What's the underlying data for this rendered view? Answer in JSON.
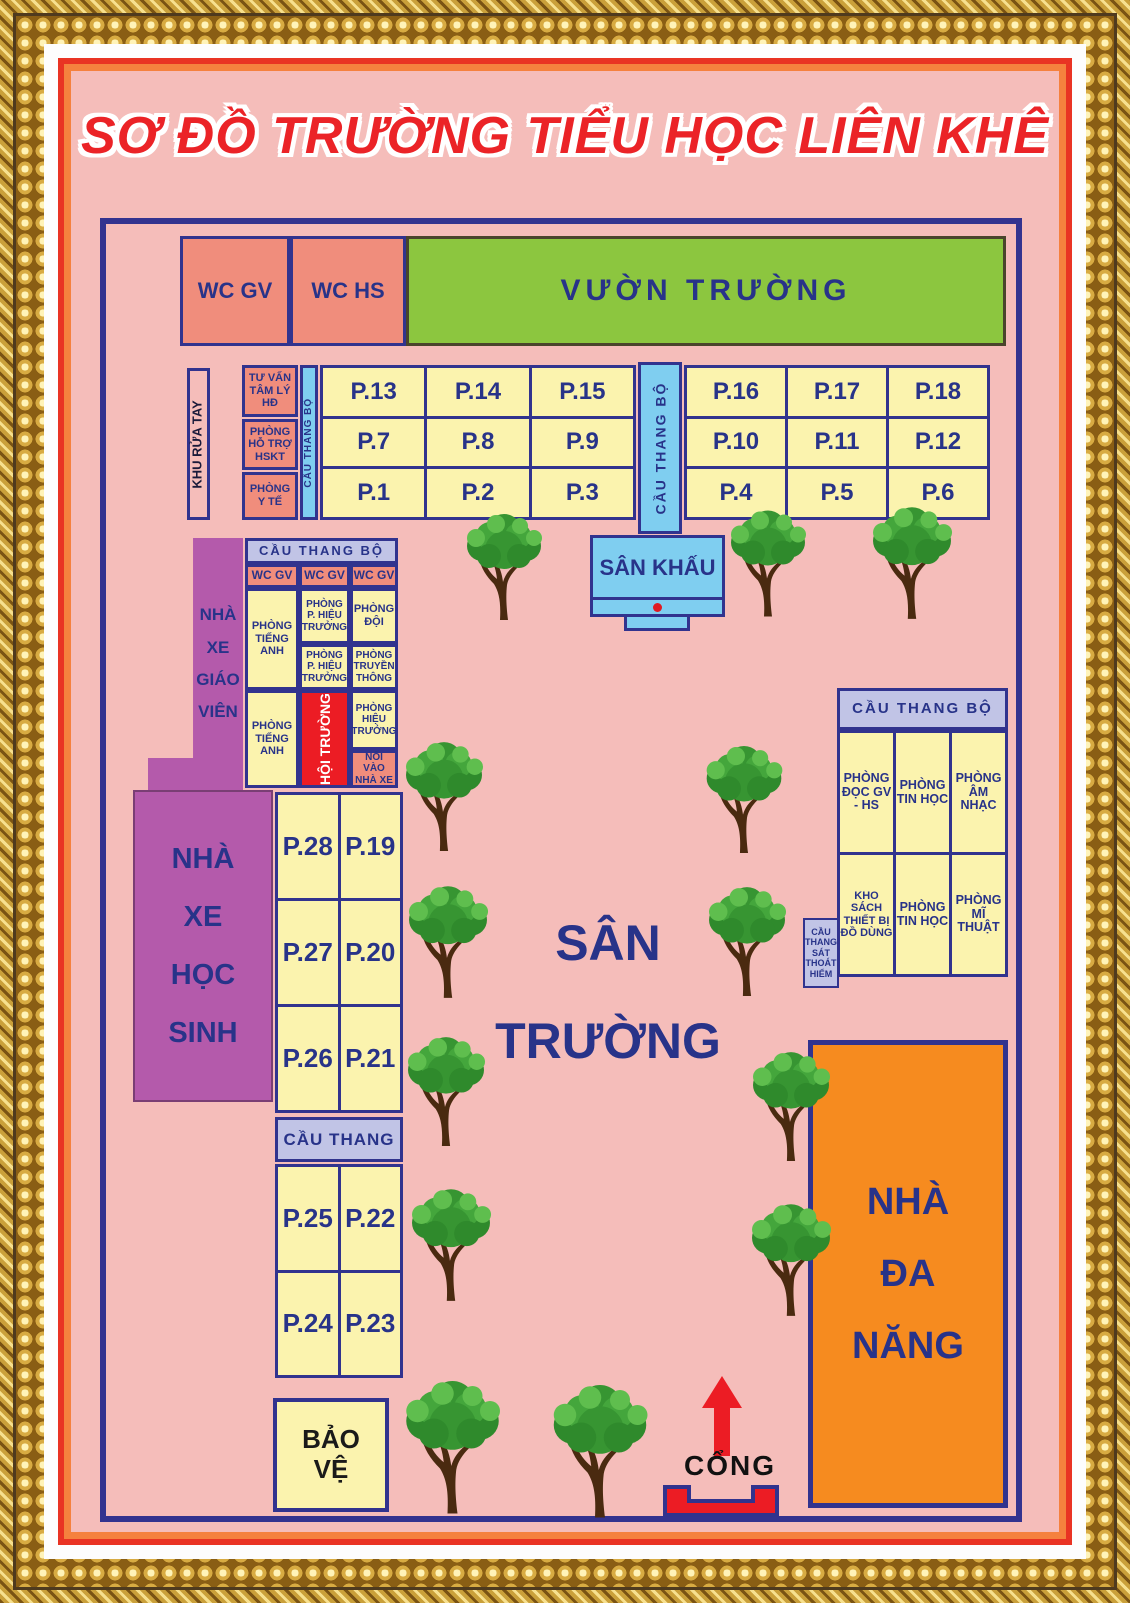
{
  "title": "SƠ ĐỒ TRƯỜNG TIỂU HỌC LIÊN KHÊ",
  "north": {
    "wc_gv": "WC GV",
    "wc_hs": "WC HS",
    "garden": "VƯỜN TRƯỜNG",
    "wash": "KHU RỬA TAY",
    "counsel": "TƯ VẤN TÂM LÝ HĐ",
    "support": "PHÒNG HỖ TRỢ HSKT",
    "medical": "PHÒNG Y TẾ",
    "stair_west": "CẦU THANG BỘ",
    "stair_mid": "CẦU THANG BỘ",
    "rooms_west": [
      [
        "P.13",
        "P.14",
        "P.15"
      ],
      [
        "P.7",
        "P.8",
        "P.9"
      ],
      [
        "P.1",
        "P.2",
        "P.3"
      ]
    ],
    "rooms_east": [
      [
        "P.16",
        "P.17",
        "P.18"
      ],
      [
        "P.10",
        "P.11",
        "P.12"
      ],
      [
        "P.4",
        "P.5",
        "P.6"
      ]
    ]
  },
  "stage": {
    "label": "SÂN KHẤU"
  },
  "admin": {
    "stair": "CẦU THANG BỘ",
    "wc": [
      "WC GV",
      "WC GV",
      "WC GV"
    ],
    "english1": "PHÒNG TIẾNG ANH",
    "vice1": "PHÒNG P. HIỆU TRƯỞNG",
    "team": "PHÒNG ĐỘI",
    "vice2": "PHÒNG P. HIỆU TRƯỞNG",
    "media": "PHÒNG TRUYỀN THÔNG",
    "english2": "PHÒNG TIẾNG ANH",
    "hall": "HỘI TRƯỜNG",
    "principal": "PHÒNG HIỆU TRƯỞNG",
    "to_parking": "NỐI VÀO NHÀ XE"
  },
  "parking": {
    "teacher": "NHÀ XE GIÁO VIÊN",
    "student": "NHÀ XE HỌC SINH"
  },
  "west_rooms": {
    "grid1": [
      [
        "P.28",
        "P.19"
      ],
      [
        "P.27",
        "P.20"
      ],
      [
        "P.26",
        "P.21"
      ]
    ],
    "stair": "CẦU THANG",
    "grid2": [
      [
        "P.25",
        "P.22"
      ],
      [
        "P.24",
        "P.23"
      ]
    ]
  },
  "guard": "BẢO VỆ",
  "yard": "SÂN TRƯỜNG",
  "east": {
    "stair": "CẦU THANG BỘ",
    "reading": "PHÒNG ĐỌC GV - HS",
    "computer1": "PHÒNG TIN HỌC",
    "music": "PHÒNG ÂM NHẠC",
    "storage": "KHO SÁCH THIẾT BỊ ĐỒ DÙNG",
    "computer2": "PHÒNG TIN HỌC",
    "art": "PHÒNG MĨ THUẬT",
    "escape": "CẦU THANG SÁT THOÁT HIỂM"
  },
  "multi_hall": "NHÀ ĐA NĂNG",
  "gate": "CỔNG",
  "icons": {
    "tree": "tree-icon",
    "gate_arrow": "gate-arrow-icon",
    "stage_marker": "stage-marker-dot"
  },
  "colors": {
    "background_pink": "#F5BDBA",
    "navy": "#2F3390",
    "salmon": "#F08D7C",
    "room_yellow": "#FBF3AE",
    "garden_green": "#8CC63F",
    "stair_blue": "#7FCEF0",
    "stair_lavender": "#C1C4E6",
    "parking_purple": "#B45AAB",
    "hall_red": "#EC1C24",
    "multi_orange": "#F68B1F",
    "title_red": "#EB2327",
    "frame_gold": "#D8AB42"
  }
}
